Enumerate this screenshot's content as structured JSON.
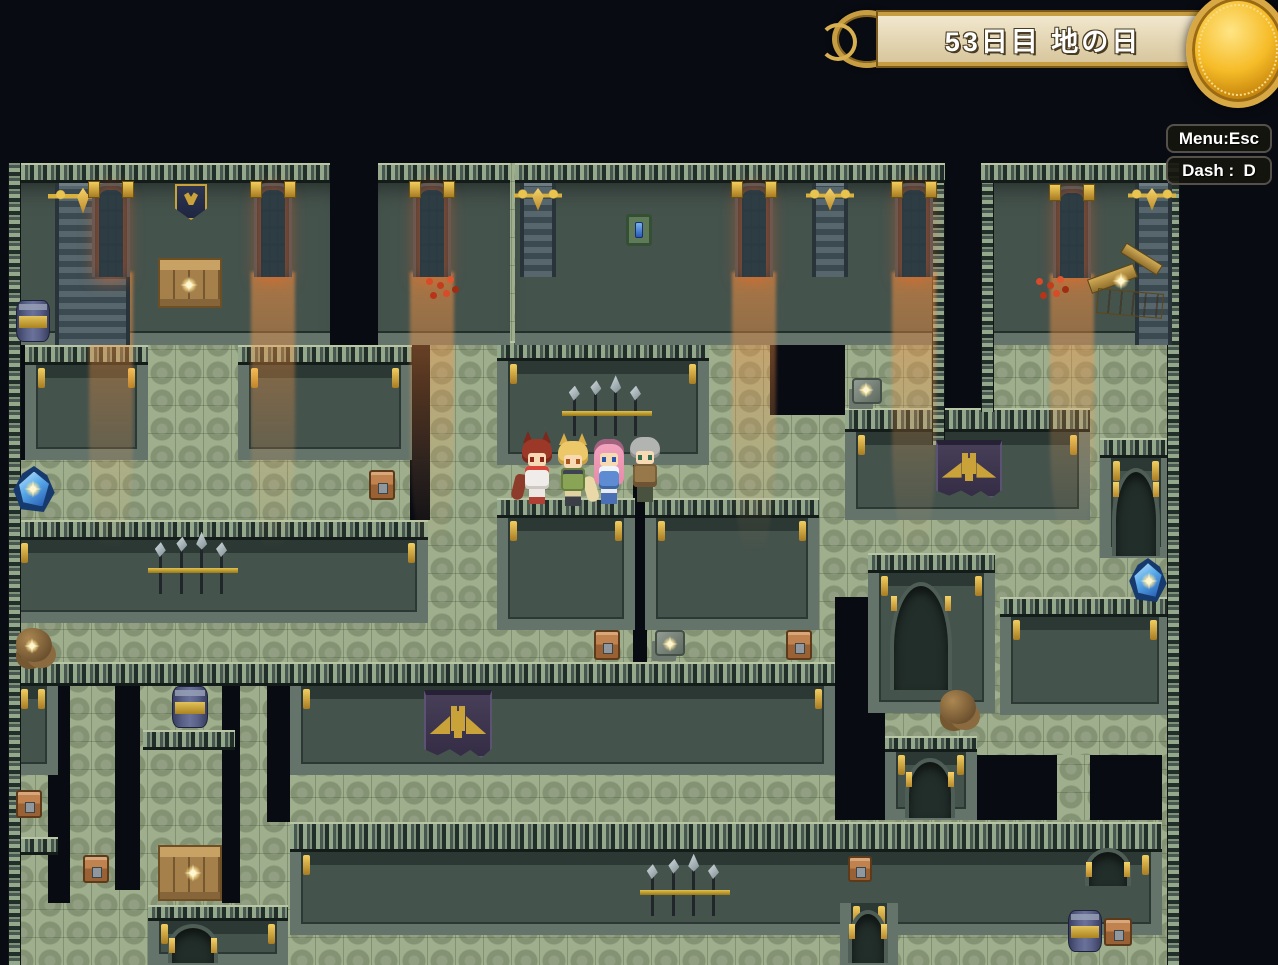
{
  "hud": {
    "day_banner": {
      "text": "53日目 地の日"
    },
    "shortcut_menu": "Menu:Esc",
    "shortcut_dash": "Dash :  D"
  },
  "scene": {
    "colors": {
      "floor_green": "#9fae8c",
      "wall_teal": "#45534d",
      "door_glow": "#f34c12",
      "banner_gold": "#c9a23a",
      "crystal_blue": "#58a9e9",
      "parchment": "#e8dcb8"
    },
    "objects": [
      {
        "t": "bigpillar",
        "n": "wall-pillar",
        "x": 55,
        "y": 183,
        "w": 75,
        "h": 162,
        "i": false
      },
      {
        "t": "pillar",
        "n": "wall-pillar",
        "x": 520,
        "y": 183,
        "w": 36,
        "h": 94,
        "i": false
      },
      {
        "t": "pillar",
        "n": "wall-pillar",
        "x": 812,
        "y": 183,
        "w": 36,
        "h": 94,
        "i": false
      },
      {
        "t": "bigpillar",
        "n": "wall-pillar",
        "x": 1135,
        "y": 183,
        "w": 37,
        "h": 162,
        "i": false
      },
      {
        "t": "goldorn",
        "n": "gold-ornament-icon",
        "x": 48,
        "y": 181,
        "w": 70,
        "h": 34,
        "i": false
      },
      {
        "t": "goldorn",
        "n": "gold-ornament-icon",
        "x": 514,
        "y": 182,
        "w": 48,
        "h": 30,
        "i": false
      },
      {
        "t": "goldorn",
        "n": "gold-ornament-icon",
        "x": 806,
        "y": 182,
        "w": 48,
        "h": 30,
        "i": false
      },
      {
        "t": "goldorn",
        "n": "gold-ornament-icon",
        "x": 1128,
        "y": 182,
        "w": 48,
        "h": 30,
        "i": false
      },
      {
        "t": "lightbeam",
        "n": "door-light-beam",
        "x": 89,
        "y": 272,
        "w": 44,
        "h": 280,
        "i": false
      },
      {
        "t": "lightbeam",
        "n": "door-light-beam",
        "x": 251,
        "y": 272,
        "w": 44,
        "h": 280,
        "i": false
      },
      {
        "t": "lightbeam",
        "n": "door-light-beam",
        "x": 410,
        "y": 272,
        "w": 44,
        "h": 280,
        "i": false
      },
      {
        "t": "lightbeam",
        "n": "door-light-beam",
        "x": 732,
        "y": 272,
        "w": 44,
        "h": 280,
        "i": false
      },
      {
        "t": "lightbeam",
        "n": "door-light-beam",
        "x": 892,
        "y": 272,
        "w": 44,
        "h": 280,
        "i": false
      },
      {
        "t": "lightbeam",
        "n": "door-light-beam",
        "x": 1050,
        "y": 274,
        "w": 44,
        "h": 270,
        "i": false
      },
      {
        "t": "reddoor",
        "n": "glowing-door",
        "x": 92,
        "y": 183,
        "w": 38,
        "h": 94,
        "i": true
      },
      {
        "t": "reddoor",
        "n": "glowing-door",
        "x": 254,
        "y": 183,
        "w": 38,
        "h": 94,
        "i": true
      },
      {
        "t": "reddoor",
        "n": "glowing-door",
        "x": 413,
        "y": 183,
        "w": 38,
        "h": 94,
        "i": true
      },
      {
        "t": "reddoor",
        "n": "glowing-door",
        "x": 735,
        "y": 183,
        "w": 38,
        "h": 94,
        "i": true
      },
      {
        "t": "reddoor",
        "n": "glowing-door",
        "x": 895,
        "y": 183,
        "w": 38,
        "h": 94,
        "i": true
      },
      {
        "t": "reddoor",
        "n": "glowing-door",
        "x": 1053,
        "y": 186,
        "w": 38,
        "h": 92,
        "i": true
      },
      {
        "t": "shield",
        "n": "wall-shield-emblem",
        "x": 175,
        "y": 184,
        "w": 32,
        "h": 36,
        "i": false
      },
      {
        "t": "switch",
        "n": "wall-gem-switch",
        "x": 626,
        "y": 214,
        "w": 26,
        "h": 32,
        "i": true
      },
      {
        "t": "rack",
        "n": "weapon-rack",
        "x": 562,
        "y": 384,
        "w": 90,
        "h": 52,
        "i": false
      },
      {
        "t": "rack",
        "n": "weapon-rack",
        "x": 148,
        "y": 540,
        "w": 90,
        "h": 54,
        "i": false
      },
      {
        "t": "rack",
        "n": "weapon-rack",
        "x": 640,
        "y": 862,
        "w": 90,
        "h": 54,
        "i": false
      },
      {
        "t": "banner",
        "n": "eagle-banner",
        "x": 936,
        "y": 440,
        "w": 66,
        "h": 58,
        "i": false
      },
      {
        "t": "banner",
        "n": "eagle-banner",
        "x": 424,
        "y": 690,
        "w": 68,
        "h": 68,
        "i": false
      },
      {
        "t": "crates",
        "n": "crate-stack",
        "x": 158,
        "y": 258,
        "w": 64,
        "h": 50,
        "i": true
      },
      {
        "t": "crates",
        "n": "crate-stack",
        "x": 158,
        "y": 845,
        "w": 64,
        "h": 56,
        "i": true
      },
      {
        "t": "crates-broken",
        "n": "broken-crates",
        "x": 1088,
        "y": 246,
        "w": 94,
        "h": 82,
        "i": true
      },
      {
        "t": "barrel",
        "n": "barrel",
        "x": 16,
        "y": 300,
        "w": 34,
        "h": 42,
        "i": true
      },
      {
        "t": "barrel",
        "n": "barrel",
        "x": 172,
        "y": 686,
        "w": 36,
        "h": 42,
        "i": true
      },
      {
        "t": "barrel",
        "n": "barrel",
        "x": 1068,
        "y": 910,
        "w": 34,
        "h": 42,
        "i": true
      },
      {
        "t": "chest",
        "n": "treasure-chest",
        "x": 369,
        "y": 470,
        "w": 26,
        "h": 30,
        "i": true
      },
      {
        "t": "chest",
        "n": "treasure-chest",
        "x": 594,
        "y": 630,
        "w": 26,
        "h": 30,
        "i": true
      },
      {
        "t": "chest",
        "n": "treasure-chest",
        "x": 786,
        "y": 630,
        "w": 26,
        "h": 30,
        "i": true
      },
      {
        "t": "chest",
        "n": "treasure-chest",
        "x": 16,
        "y": 790,
        "w": 26,
        "h": 28,
        "i": true
      },
      {
        "t": "chest",
        "n": "treasure-chest",
        "x": 83,
        "y": 855,
        "w": 26,
        "h": 28,
        "i": true
      },
      {
        "t": "chest",
        "n": "treasure-chest",
        "x": 848,
        "y": 856,
        "w": 24,
        "h": 26,
        "i": true
      },
      {
        "t": "chest",
        "n": "treasure-chest",
        "x": 1104,
        "y": 918,
        "w": 28,
        "h": 28,
        "i": true
      },
      {
        "t": "crystal",
        "n": "blue-crystal",
        "x": 12,
        "y": 466,
        "w": 44,
        "h": 46,
        "i": true
      },
      {
        "t": "crystal",
        "n": "blue-crystal",
        "x": 1128,
        "y": 558,
        "w": 40,
        "h": 44,
        "i": true
      },
      {
        "t": "rocks",
        "n": "rock-pile",
        "x": 16,
        "y": 628,
        "w": 36,
        "h": 34,
        "i": true
      },
      {
        "t": "rocks",
        "n": "rock-pile",
        "x": 940,
        "y": 690,
        "w": 36,
        "h": 34,
        "i": true
      },
      {
        "t": "stone",
        "n": "stone-block",
        "x": 852,
        "y": 378,
        "w": 30,
        "h": 26,
        "i": true
      },
      {
        "t": "stone",
        "n": "stone-block",
        "x": 655,
        "y": 630,
        "w": 30,
        "h": 26,
        "i": true
      },
      {
        "t": "mushrooms",
        "n": "red-mushrooms",
        "x": 426,
        "y": 278,
        "w": 32,
        "h": 30,
        "i": true
      },
      {
        "t": "mushrooms",
        "n": "red-mushrooms",
        "x": 1036,
        "y": 278,
        "w": 32,
        "h": 30,
        "i": true
      },
      {
        "t": "arch",
        "n": "arched-doorway",
        "x": 1112,
        "y": 468,
        "w": 48,
        "h": 88,
        "i": true
      },
      {
        "t": "arch",
        "n": "arched-doorway",
        "x": 890,
        "y": 582,
        "w": 62,
        "h": 108,
        "i": true
      },
      {
        "t": "arch",
        "n": "arched-doorway",
        "x": 905,
        "y": 758,
        "w": 50,
        "h": 60,
        "i": true
      },
      {
        "t": "arch",
        "n": "arched-doorway",
        "x": 848,
        "y": 910,
        "w": 40,
        "h": 53,
        "i": true
      },
      {
        "t": "arch",
        "n": "arched-doorway",
        "x": 168,
        "y": 924,
        "w": 50,
        "h": 39,
        "i": true
      },
      {
        "t": "arch",
        "n": "arched-doorway",
        "x": 1085,
        "y": 848,
        "w": 46,
        "h": 38,
        "i": true
      },
      {
        "t": "sparkle",
        "n": "sparkle-icon",
        "x": 180,
        "y": 276,
        "w": 18,
        "h": 18,
        "i": false
      },
      {
        "t": "sparkle",
        "n": "sparkle-icon",
        "x": 184,
        "y": 864,
        "w": 18,
        "h": 18,
        "i": false
      },
      {
        "t": "sparkle",
        "n": "sparkle-icon",
        "x": 1112,
        "y": 272,
        "w": 18,
        "h": 18,
        "i": false
      },
      {
        "t": "sparkle",
        "n": "sparkle-icon",
        "x": 24,
        "y": 480,
        "w": 18,
        "h": 18,
        "i": false
      },
      {
        "t": "sparkle",
        "n": "sparkle-icon",
        "x": 1140,
        "y": 572,
        "w": 18,
        "h": 18,
        "i": false
      },
      {
        "t": "sparkle",
        "n": "sparkle-icon",
        "x": 858,
        "y": 382,
        "w": 16,
        "h": 16,
        "i": false
      },
      {
        "t": "sparkle",
        "n": "sparkle-icon",
        "x": 662,
        "y": 636,
        "w": 16,
        "h": 16,
        "i": false
      },
      {
        "t": "sparkle",
        "n": "sparkle-icon",
        "x": 24,
        "y": 638,
        "w": 16,
        "h": 16,
        "i": false
      },
      {
        "t": "char",
        "v": "c1",
        "n": "party-member-red-wolf-girl",
        "x": 520,
        "y": 430,
        "w": 34,
        "h": 74,
        "i": true
      },
      {
        "t": "char",
        "v": "c2",
        "n": "party-member-blonde-cat-girl",
        "x": 556,
        "y": 432,
        "w": 34,
        "h": 72,
        "i": true
      },
      {
        "t": "char",
        "v": "c3",
        "n": "party-member-pink-hair-girl",
        "x": 592,
        "y": 430,
        "w": 34,
        "h": 74,
        "i": true
      },
      {
        "t": "char",
        "v": "c4",
        "n": "party-member-grey-hair-man",
        "x": 628,
        "y": 428,
        "w": 34,
        "h": 76,
        "i": true
      }
    ]
  }
}
